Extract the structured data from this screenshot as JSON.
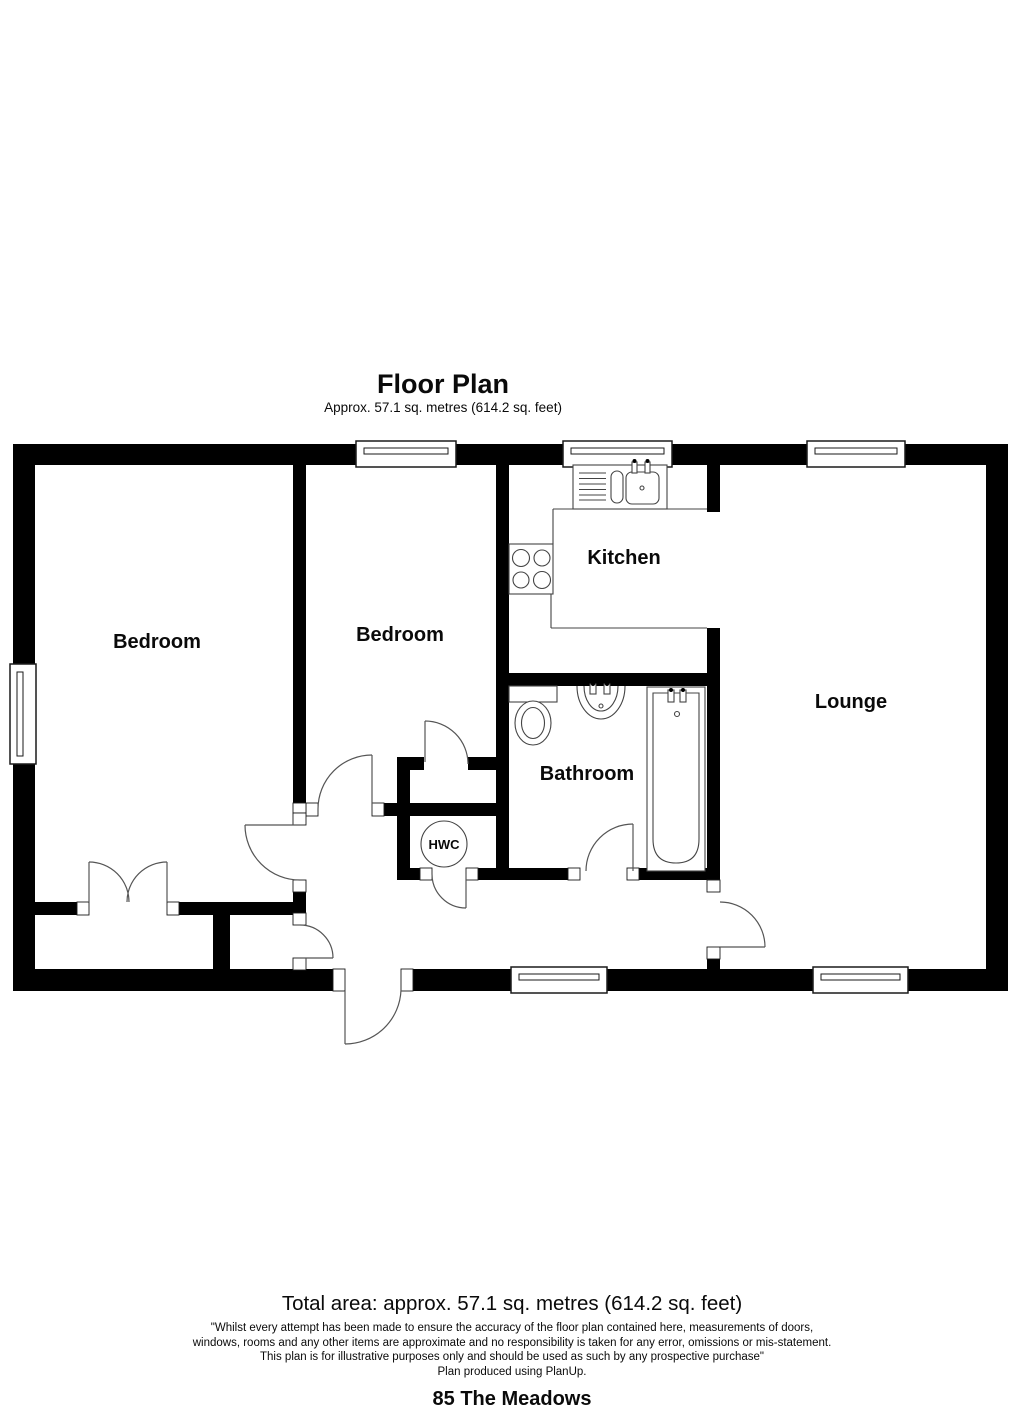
{
  "header": {
    "title": "Floor Plan",
    "subtitle": "Approx. 57.1 sq. metres (614.2 sq. feet)"
  },
  "rooms": {
    "bedroom1": "Bedroom",
    "bedroom2": "Bedroom",
    "kitchen": "Kitchen",
    "lounge": "Lounge",
    "bathroom": "Bathroom",
    "hwc": "HWC"
  },
  "footer": {
    "total_area": "Total area: approx. 57.1 sq. metres (614.2 sq. feet)",
    "disclaimer": [
      "\"Whilst every attempt has been made to ensure the accuracy of the floor plan contained here, measurements of doors,",
      "windows, rooms and any other items are approximate and no responsibility is taken for any error, omissions or mis-statement.",
      "This plan is for illustrative purposes only and should be used as such by any prospective purchase\"",
      "Plan produced using PlanUp."
    ],
    "address": "85 The Meadows"
  },
  "colors": {
    "wall": "#000000",
    "fixture_line": "#444444",
    "background": "#ffffff"
  }
}
